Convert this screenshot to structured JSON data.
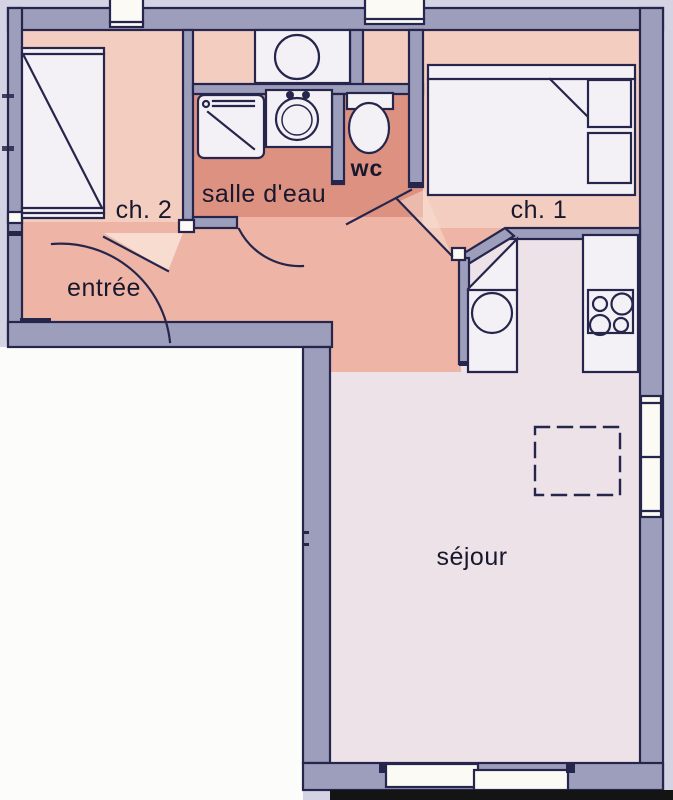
{
  "plan": {
    "rooms": [
      {
        "id": "ch2",
        "label": "ch. 2"
      },
      {
        "id": "salle_deau",
        "label": "salle d'eau"
      },
      {
        "id": "wc",
        "label": "wc"
      },
      {
        "id": "ch1",
        "label": "ch. 1"
      },
      {
        "id": "entree",
        "label": "entrée"
      },
      {
        "id": "sejour",
        "label": "séjour"
      }
    ],
    "colors": {
      "margin": "#d3d3e4",
      "exterior": "#fcfcfa",
      "wall": "#9d9dbc",
      "outline": "#26264c",
      "pinkHall": "#eeb5a6",
      "pinkRoom": "#f3cec0",
      "bath": "#dd9181",
      "pale": "#ece2e7",
      "swing": "#f7dccf",
      "furniture": "#f4f1f6",
      "window": "#fbfaf4",
      "shadow": "#141414"
    }
  }
}
